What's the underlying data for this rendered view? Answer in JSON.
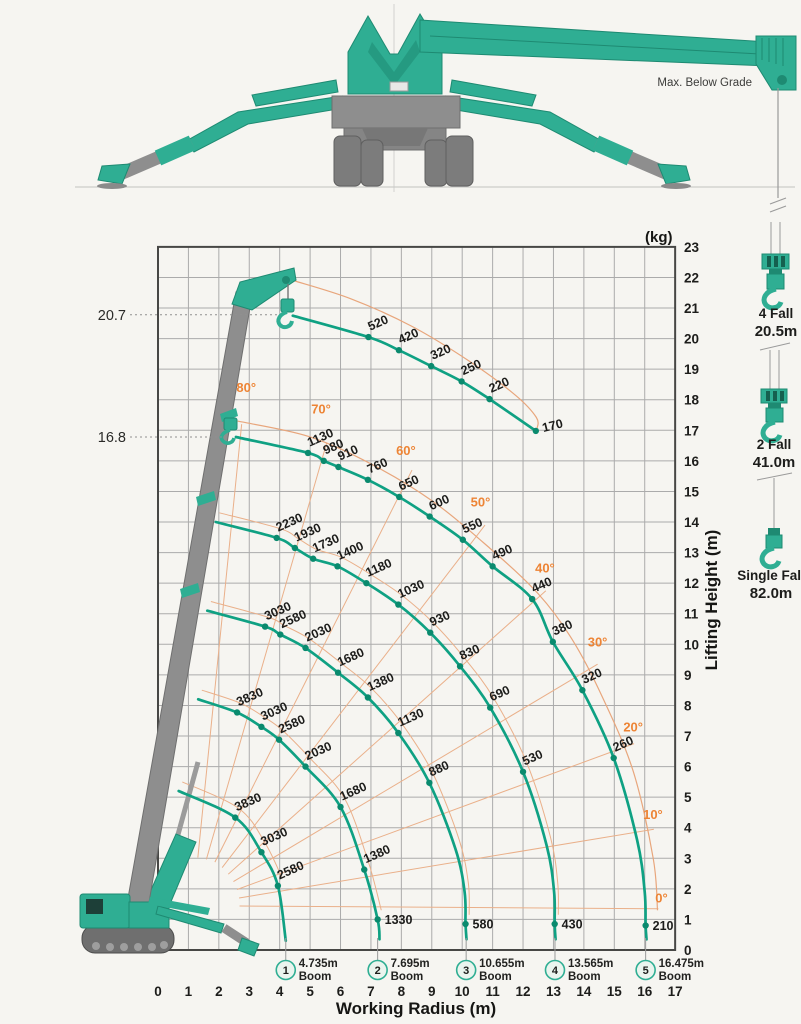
{
  "illustration": {
    "max_below_grade": "Max. Below Grade"
  },
  "hook_configs": [
    {
      "falls": "4 Fall",
      "rope_length": "20.5m"
    },
    {
      "falls": "2 Fall",
      "rope_length": "41.0m"
    },
    {
      "falls": "Single Fall",
      "rope_length": "82.0m"
    }
  ],
  "chart_data": {
    "type": "line",
    "unit": "(kg)",
    "xlabel": "Working Radius (m)",
    "ylabel": "Lifting Height (m)",
    "xlim": [
      0,
      17
    ],
    "ylim": [
      0,
      23
    ],
    "x_ticks": [
      "0",
      "1",
      "2",
      "3",
      "4",
      "5",
      "6",
      "7",
      "8",
      "9",
      "10",
      "11",
      "12",
      "13",
      "14",
      "15",
      "16",
      "17"
    ],
    "y_ticks": [
      "0",
      "1",
      "2",
      "3",
      "4",
      "5",
      "6",
      "7",
      "8",
      "9",
      "10",
      "11",
      "12",
      "13",
      "14",
      "15",
      "16",
      "17",
      "18",
      "19",
      "20",
      "21",
      "22",
      "23"
    ],
    "height_markers": [
      {
        "label": "20.7",
        "h": 20.78,
        "line_to_r": 3.94
      },
      {
        "label": "16.8",
        "h": 16.78,
        "line_to_r": 2.1
      }
    ],
    "boom_angle_lines": {
      "pivot": [
        1.15,
        1.45
      ],
      "lines": [
        {
          "label": "80°",
          "end": [
            2.75,
            17.2
          ],
          "label_pos": [
            2.9,
            18.25
          ]
        },
        {
          "label": "70°",
          "end": [
            5.55,
            16.6
          ],
          "label_pos": [
            5.36,
            17.55
          ]
        },
        {
          "label": "60°",
          "end": [
            8.35,
            15.7
          ],
          "label_pos": [
            8.15,
            16.2
          ]
        },
        {
          "label": "50°",
          "end": [
            10.75,
            13.9
          ],
          "label_pos": [
            10.6,
            14.5
          ]
        },
        {
          "label": "40°",
          "end": [
            12.75,
            11.75
          ],
          "label_pos": [
            12.72,
            12.35
          ]
        },
        {
          "label": "30°",
          "end": [
            14.45,
            9.35
          ],
          "label_pos": [
            14.45,
            9.92
          ]
        },
        {
          "label": "20°",
          "end": [
            15.65,
            6.75
          ],
          "label_pos": [
            15.62,
            7.15
          ]
        },
        {
          "label": "10°",
          "end": [
            16.3,
            3.95
          ],
          "label_pos": [
            16.27,
            4.28
          ]
        },
        {
          "label": "0°",
          "end": [
            16.45,
            1.35
          ],
          "label_pos": [
            16.55,
            1.55
          ]
        }
      ]
    },
    "boundaries": [
      [
        [
          2.62,
          17.3
        ],
        [
          4.95,
          16.8
        ],
        [
          7.0,
          15.9
        ],
        [
          9.0,
          14.7
        ],
        [
          10.9,
          13.15
        ],
        [
          12.5,
          11.65
        ],
        [
          13.62,
          10.15
        ],
        [
          14.62,
          8.25
        ],
        [
          15.62,
          5.85
        ],
        [
          16.28,
          3.0
        ],
        [
          16.42,
          1.3
        ]
      ],
      [
        [
          4.45,
          21.9
        ],
        [
          6.35,
          21.3
        ],
        [
          8.35,
          20.4
        ],
        [
          10.25,
          19.25
        ],
        [
          11.75,
          18.15
        ],
        [
          12.44,
          17.42
        ],
        [
          12.46,
          17.05
        ]
      ]
    ],
    "series": [
      {
        "name": "max-height-segment",
        "points": [
          [
            4.43,
            20.75,
            null
          ],
          [
            6.92,
            20.05,
            "520"
          ],
          [
            7.92,
            19.62,
            "420"
          ],
          [
            8.98,
            19.1,
            "320"
          ],
          [
            9.98,
            18.6,
            "250"
          ],
          [
            10.9,
            18.02,
            "220"
          ],
          [
            12.42,
            16.98,
            "170",
            "t"
          ]
        ]
      },
      {
        "name": "boom-5-16.475m",
        "points": [
          [
            2.56,
            16.78,
            null
          ],
          [
            4.93,
            16.26,
            "1130"
          ],
          [
            5.45,
            16.0,
            "980"
          ],
          [
            5.93,
            15.8,
            "910"
          ],
          [
            6.9,
            15.38,
            "760"
          ],
          [
            7.93,
            14.82,
            "650"
          ],
          [
            8.93,
            14.18,
            "600"
          ],
          [
            10.02,
            13.42,
            "550"
          ],
          [
            11.0,
            12.55,
            "490"
          ],
          [
            12.3,
            11.48,
            "440"
          ],
          [
            12.98,
            10.08,
            "380"
          ],
          [
            13.95,
            8.5,
            "320"
          ],
          [
            14.98,
            6.28,
            "260"
          ],
          [
            15.75,
            3.6,
            null
          ],
          [
            16.0,
            1.9,
            null
          ],
          [
            16.03,
            0.8,
            "210",
            "e"
          ],
          [
            16.06,
            0.35,
            null
          ]
        ]
      },
      {
        "name": "boom-4-13.565m",
        "points": [
          [
            1.9,
            14.0,
            null
          ],
          [
            3.9,
            13.48,
            "2230"
          ],
          [
            4.5,
            13.15,
            "1930"
          ],
          [
            5.1,
            12.8,
            "1730"
          ],
          [
            5.9,
            12.55,
            "1400"
          ],
          [
            6.85,
            12.0,
            "1180"
          ],
          [
            7.9,
            11.3,
            "1030"
          ],
          [
            8.95,
            10.38,
            "930"
          ],
          [
            9.93,
            9.28,
            "830"
          ],
          [
            10.92,
            7.93,
            "690"
          ],
          [
            12.0,
            5.83,
            "530"
          ],
          [
            12.78,
            3.4,
            null
          ],
          [
            13.02,
            1.9,
            null
          ],
          [
            13.04,
            0.85,
            "430",
            "e"
          ],
          [
            13.07,
            0.35,
            null
          ]
        ]
      },
      {
        "name": "boom-3-10.655m",
        "points": [
          [
            1.62,
            11.1,
            null
          ],
          [
            3.52,
            10.58,
            "3030"
          ],
          [
            4.02,
            10.32,
            "2580"
          ],
          [
            4.85,
            9.88,
            "2030"
          ],
          [
            5.92,
            9.07,
            "1680"
          ],
          [
            6.9,
            8.26,
            "1380"
          ],
          [
            7.9,
            7.1,
            "1130"
          ],
          [
            8.92,
            5.47,
            "880"
          ],
          [
            9.78,
            3.3,
            null
          ],
          [
            10.08,
            1.9,
            null
          ],
          [
            10.11,
            0.85,
            "580",
            "e"
          ],
          [
            10.14,
            0.35,
            null
          ]
        ]
      },
      {
        "name": "boom-2-7.695m",
        "points": [
          [
            1.32,
            8.2,
            null
          ],
          [
            2.6,
            7.77,
            "3830"
          ],
          [
            3.4,
            7.3,
            "3030"
          ],
          [
            3.98,
            6.88,
            "2580"
          ],
          [
            4.85,
            6.0,
            "2030"
          ],
          [
            6.0,
            4.68,
            "1680"
          ],
          [
            6.78,
            2.63,
            "1380"
          ],
          [
            7.22,
            1.0,
            "1330",
            "e"
          ],
          [
            7.28,
            0.35,
            null
          ]
        ]
      },
      {
        "name": "boom-1-4.735m",
        "points": [
          [
            0.68,
            5.2,
            null
          ],
          [
            2.54,
            4.33,
            "3830"
          ],
          [
            3.4,
            3.2,
            "3030"
          ],
          [
            3.94,
            2.1,
            "2580"
          ],
          [
            4.2,
            0.3,
            null
          ]
        ]
      }
    ],
    "booms": [
      {
        "num": "1",
        "length": "4.735m",
        "caption": "Boom",
        "r": 4.2
      },
      {
        "num": "2",
        "length": "7.695m",
        "caption": "Boom",
        "r": 7.22
      },
      {
        "num": "3",
        "length": "10.655m",
        "caption": "Boom",
        "r": 10.13
      },
      {
        "num": "4",
        "length": "13.565m",
        "caption": "Boom",
        "r": 13.05
      },
      {
        "num": "5",
        "length": "16.475m",
        "caption": "Boom",
        "r": 16.03
      }
    ]
  },
  "colors": {
    "green": "#2fae93",
    "green_dark": "#1e8a72",
    "curve": "#0fa183",
    "dot": "#0a8a6e",
    "orange_line": "#eab08a",
    "orange_boundary": "#e8a67c",
    "orange_label": "#ed8435",
    "gray": "#8e8e8e",
    "grid": "#ababab",
    "border": "#474745"
  }
}
